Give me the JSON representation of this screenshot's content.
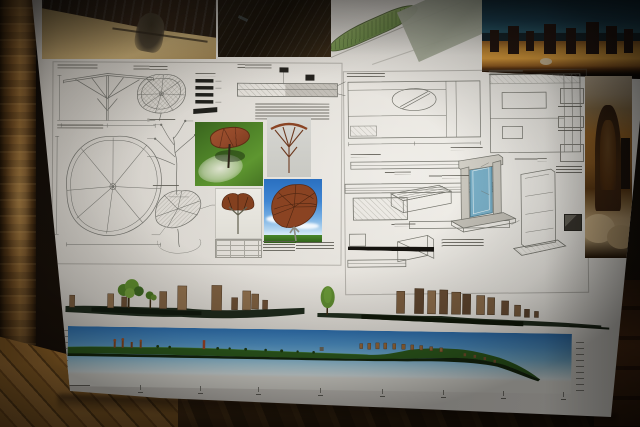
{
  "scene": {
    "subject": "architectural-presentation-board",
    "setting": {
      "floor": "wood-parquet",
      "left_edge": "wooden-door-frame",
      "background": "dark-room"
    }
  },
  "top_row_photos": [
    {
      "name": "sand-site-photo-with-shadow",
      "colors": {
        "sand": "#b59a66",
        "tarp": "#2a1e12",
        "shadow": "#40382a"
      }
    },
    {
      "name": "dark-roof-photo",
      "colors": {
        "base": "#191209"
      }
    },
    {
      "name": "tilted-site-plan-sheet",
      "colors": {
        "paper": "#c3c3b9",
        "plan_green": "#7c9c58",
        "field": "#a9ae9c"
      }
    },
    {
      "name": "standing-stones-field-photo",
      "colors": {
        "sky": "#1d4254",
        "grass": "#c08732",
        "stones": "#241610"
      }
    }
  ],
  "board": {
    "paper_color": "#e6e2da",
    "line_color": "#70706a",
    "left_sheet": {
      "subject": "leaf-canopy-shade-structure",
      "drawings": [
        "front-elevation",
        "canopy-grid-plan",
        "slat-details",
        "anchor-section",
        "canopy-frame-plan",
        "branching-support-detail",
        "canopy-perspective"
      ]
    },
    "right_sheet": {
      "subject": "site-elements-details",
      "drawings": [
        "wall-section",
        "gate-section",
        "edge-profiles",
        "hatched-plan",
        "bench-axonometric",
        "glazed-portal-axonometric",
        "stele-frame-axonometric",
        "ramp-wedge",
        "black-scale-bar"
      ],
      "portal_glass_color": "#7ab0c8"
    },
    "renders": [
      {
        "name": "canopy-on-grass",
        "background": "#4e8228",
        "canopy": "#93492a"
      },
      {
        "name": "canopy-structure-grey",
        "background": "#d2d2cc",
        "canopy": "#8a4424"
      },
      {
        "name": "canopy-small-white",
        "background": "#e8e6e0",
        "canopy": "#83401f"
      },
      {
        "name": "canopy-under-blue-sky",
        "sky": "#2f7cc4",
        "grass": "#3e7a22",
        "canopy": "#8a4322"
      }
    ],
    "khachkar_photo": {
      "name": "carved-stone-photo",
      "colors": {
        "sky": "#b2a28a",
        "field": "#9a6626",
        "stone": "#3a2412",
        "rocks": "#c4aa7e"
      }
    },
    "site_elevation_strip": {
      "stones_left": 10,
      "stones_right": 12,
      "trees": 3,
      "ground_color": "#1f2a1c",
      "stone_color": "#7d5f40"
    },
    "panorama_section": {
      "sky_top": "#2e6fae",
      "sky_horizon": "#dceef6",
      "terrain": "#2f5e1e",
      "stone_accents": "#9a6a3a",
      "ruler_ticks": 8,
      "has_left_scale": true,
      "has_right_scale": true
    }
  },
  "environment": {
    "wood_frame": "#8a6232",
    "floor_light": "#a9742e",
    "floor_dark": "#2a1608"
  }
}
